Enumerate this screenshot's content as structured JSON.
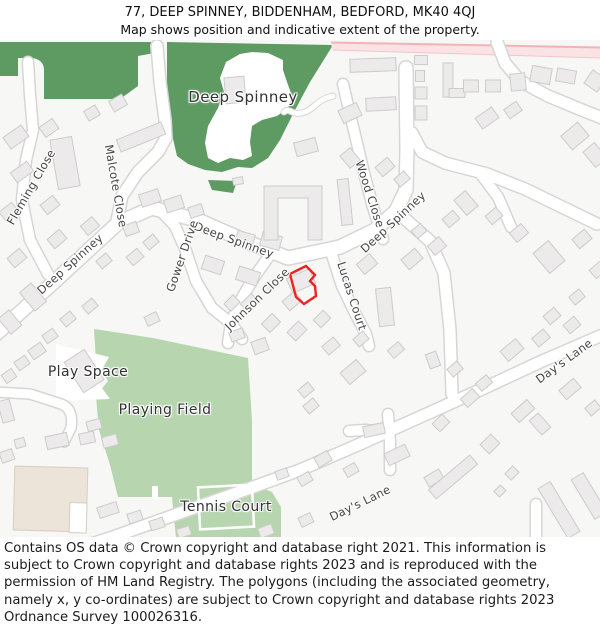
{
  "header": {
    "line1": "77, DEEP SPINNEY, BIDDENHAM, BEDFORD, MK40 4QJ",
    "line2": "Map shows position and indicative extent of the property."
  },
  "footer": {
    "copyright": "Contains OS data © Crown copyright and database right 2021. This information is subject to Crown copyright and database rights 2023 and is reproduced with the permission of HM Land Registry. The polygons (including the associated geometry, namely x, y co-ordinates) are subject to Crown copyright and database rights 2023 Ordnance Survey 100026316."
  },
  "map": {
    "colors": {
      "bg": "#f7f7f5",
      "wood_green": "#5e9b62",
      "field_green": "#b7d6b0",
      "building": "#eceaea",
      "building_stroke": "#cccccb",
      "road_casing": "#d6d6d4",
      "road_fill": "#ffffff",
      "pink_road": "#fbe2e4",
      "pink_edge": "#f0b3b8",
      "beige_building": "#ece4d9",
      "beige_stroke": "#d8cec0",
      "property_red": "#ee2222",
      "street_label": "#454545",
      "area_label": "#333333"
    },
    "labels": [
      {
        "text": "Deep Spinney",
        "x": 243,
        "y": 97,
        "rot": 0,
        "cls": "area big",
        "name": "label-deep-spinney-wood"
      },
      {
        "text": "Fleming Close",
        "x": 31,
        "y": 187,
        "rot": -60,
        "cls": "street",
        "name": "label-fleming-close"
      },
      {
        "text": "Malcote Close",
        "x": 116,
        "y": 186,
        "rot": 80,
        "cls": "street",
        "name": "label-malcote-close"
      },
      {
        "text": "Deep Spinney",
        "x": 70,
        "y": 264,
        "rot": -42,
        "cls": "street",
        "name": "label-deep-spinney-west"
      },
      {
        "text": "Deep Spinney",
        "x": 234,
        "y": 240,
        "rot": 20,
        "cls": "street",
        "name": "label-deep-spinney-mid"
      },
      {
        "text": "Deep Spinney",
        "x": 393,
        "y": 222,
        "rot": -43,
        "cls": "street",
        "name": "label-deep-spinney-east"
      },
      {
        "text": "Gower Drive",
        "x": 182,
        "y": 256,
        "rot": -71,
        "cls": "street",
        "name": "label-gower-drive"
      },
      {
        "text": "Johnson Close",
        "x": 257,
        "y": 299,
        "rot": -44,
        "cls": "street",
        "name": "label-johnson-close"
      },
      {
        "text": "Lucas Court",
        "x": 352,
        "y": 296,
        "rot": 72,
        "cls": "street",
        "name": "label-lucas-court"
      },
      {
        "text": "Wood Close",
        "x": 370,
        "y": 194,
        "rot": 72,
        "cls": "street",
        "name": "label-wood-close"
      },
      {
        "text": "Day's Lane",
        "x": 564,
        "y": 361,
        "rot": -36,
        "cls": "street",
        "name": "label-days-lane-upper"
      },
      {
        "text": "Day's Lane",
        "x": 360,
        "y": 503,
        "rot": -26,
        "cls": "street",
        "name": "label-days-lane-lower"
      },
      {
        "text": "Play Space",
        "x": 88,
        "y": 372,
        "rot": 0,
        "cls": "area",
        "name": "label-play-space"
      },
      {
        "text": "Playing Field",
        "x": 165,
        "y": 410,
        "rot": 0,
        "cls": "area",
        "name": "label-playing-field"
      },
      {
        "text": "Tennis Court",
        "x": 226,
        "y": 507,
        "rot": 0,
        "cls": "area",
        "name": "label-tennis-court"
      }
    ]
  }
}
